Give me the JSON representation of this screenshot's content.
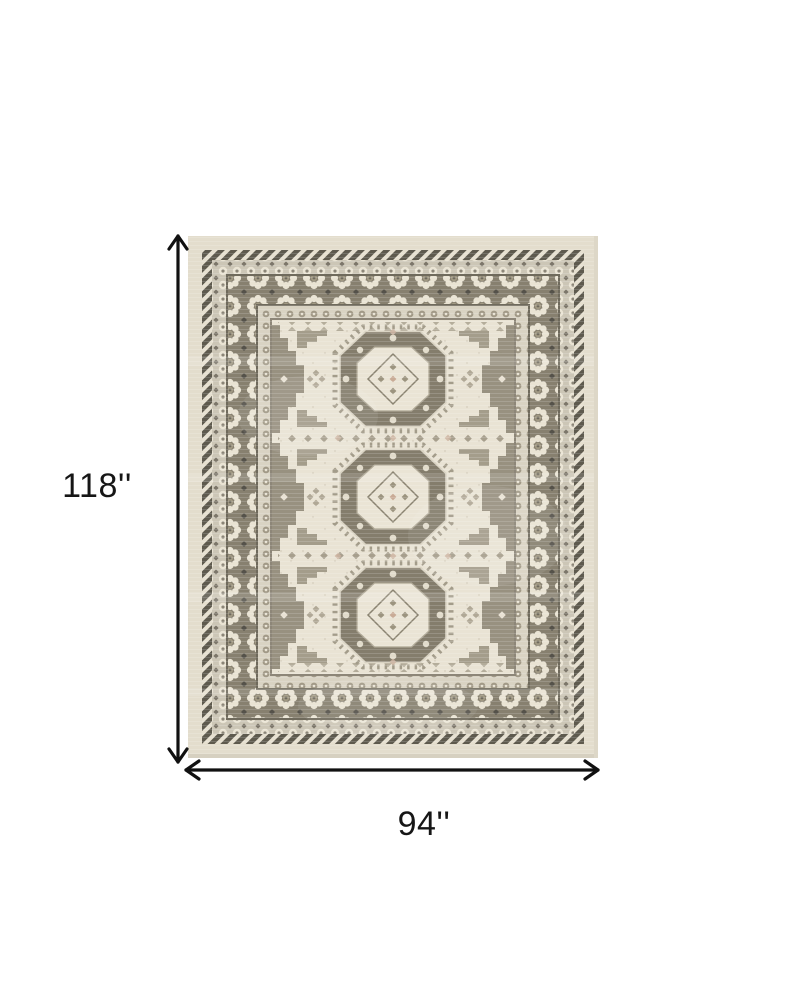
{
  "diagram": {
    "kind": "rug-dimension-diagram",
    "height_label": "118''",
    "width_label": "94''",
    "background": "#ffffff",
    "arrow_color": "#111111",
    "icons": {
      "vertical_arrow": "double-headed-vertical-dimension-arrow",
      "horizontal_arrow": "double-headed-horizontal-dimension-arrow"
    },
    "rug": {
      "description": "distressed ivory and gray oriental area rug with three octagonal medallions and ornate floral borders",
      "colors": {
        "margin_cream": "#e3ddcd",
        "field_ivory": "#e9e3d4",
        "border_ground_gray": "#87806f",
        "border_dark": "#5e5a4e",
        "rosette_cream": "#e9e3d3",
        "motif_gray": "#9c947f",
        "accent_blush": "#c9ab96"
      }
    }
  }
}
